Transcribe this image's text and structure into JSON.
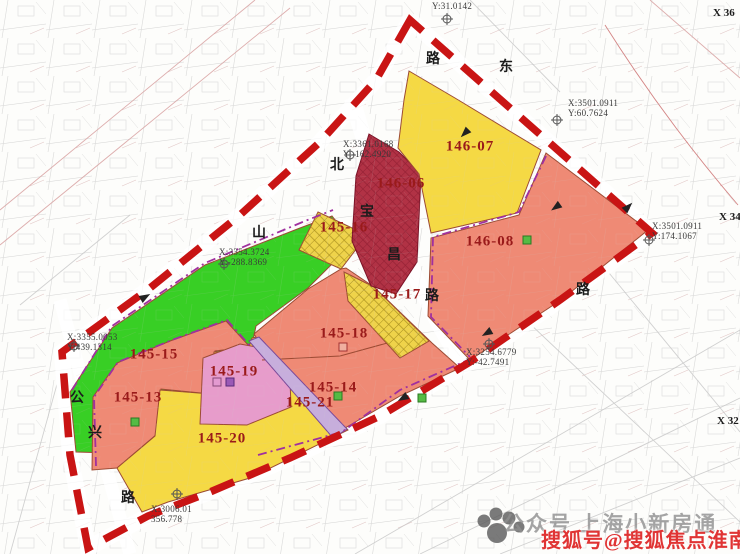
{
  "zones": {
    "z145_13": {
      "code": "145-13",
      "color": "#EF8A75"
    },
    "z145_14": {
      "code": "145-14",
      "color": "#EF8A75"
    },
    "z145_15": {
      "code": "145-15",
      "color": "#38CF25"
    },
    "z145_16": {
      "code": "145-16",
      "color": "#EFD34A"
    },
    "z145_17": {
      "code": "145-17",
      "color": "#EFD34A"
    },
    "z145_18": {
      "code": "145-18",
      "color": "#EF8A75"
    },
    "z145_19": {
      "code": "145-19",
      "color": "#E79CCB"
    },
    "z145_20": {
      "code": "145-20",
      "color": "#F5D944"
    },
    "z145_21": {
      "code": "145-21",
      "color": "#C7AEDC"
    },
    "z146_06": {
      "code": "146-06",
      "color": "#B13245"
    },
    "z146_07": {
      "code": "146-07",
      "color": "#F5D944"
    },
    "z146_08": {
      "code": "146-08",
      "color": "#EF8A75"
    }
  },
  "roads": {
    "ch1": "路",
    "ch2": "东",
    "ch3": "北",
    "ch4": "宝",
    "ch5": "昌",
    "ch6": "路",
    "ch7": "山",
    "ch8": "公",
    "ch9": "兴",
    "ch10": "路",
    "ch11": "路"
  },
  "coords": {
    "c1": {
      "l1": "Y:31.0142"
    },
    "c2": {
      "l1": "X:3501.0911",
      "l2": "Y:60.7624"
    },
    "c3": {
      "l1": "X:3361.0168",
      "l2": "Y:-162.4920"
    },
    "c4": {
      "l1": "X:3354.3724",
      "l2": "Y:-288.8369"
    },
    "c5": {
      "l1": "X:3355.0053",
      "l2": "Y:439.1314"
    },
    "c6": {
      "l1": "X:3501.0911",
      "l2": "Y:174.1067"
    },
    "c7": {
      "l1": "X:3254.6779",
      "l2": "Y:-42.7491"
    },
    "c8": {
      "l1": "X:3006.01",
      "l2": "356.778"
    }
  },
  "grid": {
    "g1": "X 36",
    "g2": "X 34",
    "g3": "X 32"
  },
  "watermarks": {
    "gray": "公众号 上海小新房通",
    "red": "搜狐号@搜狐焦点淮南站"
  },
  "colors": {
    "boundary": "#C91414",
    "purple_dash": "#A0309F",
    "zone_outline": "#9C4A33",
    "label": "#9A1A1A"
  }
}
